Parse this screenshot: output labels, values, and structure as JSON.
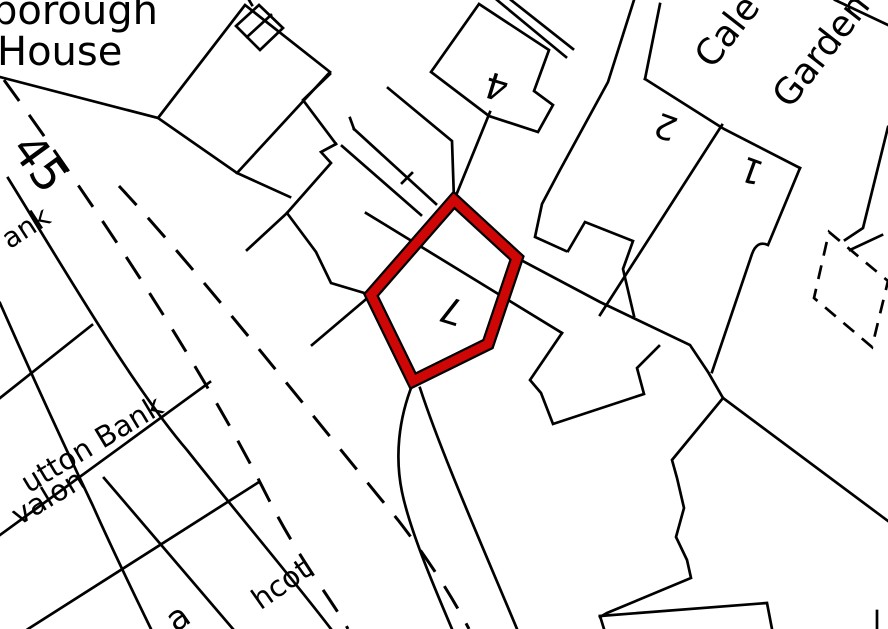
{
  "map": {
    "type": "site-location-plan",
    "colors": {
      "background": "#ffffff",
      "linework": "#000000",
      "plot_highlight_red": "#ce0606"
    },
    "highlighted_plot": {
      "number": "7",
      "outline": "thick red boundary around pentagon-shaped plot"
    },
    "labels": {
      "borough_partial": "borough",
      "house": "House",
      "road_number_partial": "45",
      "bank_partial": "ank",
      "sutton_bank_partial": "utton Bank",
      "avalon_partial": "valon",
      "hcot_partial": "hcot",
      "bottom_partial_letter": "a",
      "house_number_4": "4",
      "plot_number_7": "7",
      "house_number_2": "2",
      "house_number_1": "1",
      "street_cale_partial": "Cale",
      "street_garden_partial": "Garden"
    }
  }
}
